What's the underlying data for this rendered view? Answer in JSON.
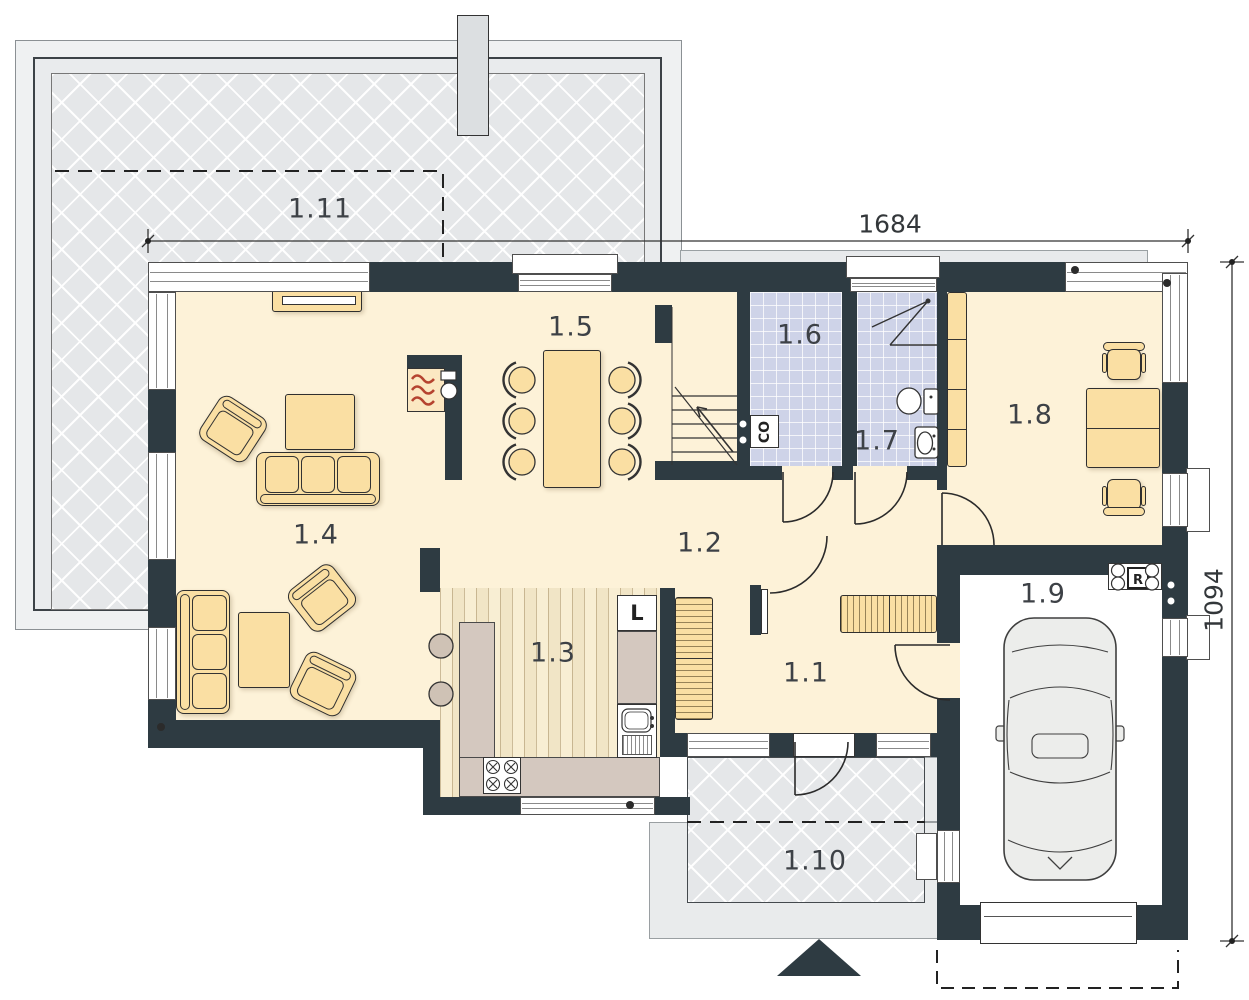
{
  "plan_title": "ground-floor-plan",
  "rooms": [
    {
      "number": "1.1"
    },
    {
      "number": "1.2"
    },
    {
      "number": "1.3"
    },
    {
      "number": "1.4"
    },
    {
      "number": "1.5"
    },
    {
      "number": "1.6"
    },
    {
      "number": "1.7"
    },
    {
      "number": "1.8"
    },
    {
      "number": "1.9"
    },
    {
      "number": "1.10"
    },
    {
      "number": "1.11"
    }
  ],
  "dimensions": {
    "top": "1684",
    "right": "1094"
  },
  "labels": {
    "boiler": "CO",
    "fridge": "L",
    "recuperator": "R"
  },
  "icons": {
    "entrance-marker-icon": "solid triangle pointing up at main entrance",
    "car-icon": "car top view in garage",
    "stairs-icon": "staircase with up arrow",
    "fireplace-icon": "fireplace with flames",
    "toilet-icon": "toilet top view",
    "washbasin-icon": "small washbasin",
    "shower-icon": "corner shower lines",
    "stove-icon": "4-burner stove",
    "sink-icon": "kitchen sink with drainer",
    "chimney-icon": "chimney block on terrace"
  },
  "colors": {
    "wall": "#2e3b42",
    "floor": "#fdf2d8",
    "furniture": "#fadfa3",
    "tile": "#ced3e8",
    "paving": "#e5e7e9",
    "wood": "#f5ead0",
    "counter": "#d4c8bf",
    "flame": "#b5432f",
    "car": "#ecedeb"
  }
}
